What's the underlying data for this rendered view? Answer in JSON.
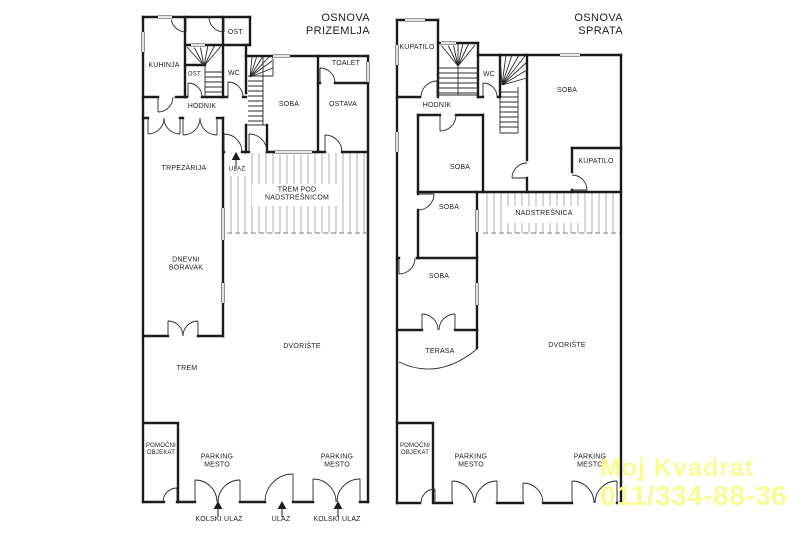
{
  "watermark": {
    "line1": "Moj Kvadrat",
    "line2": "011/334-88-36",
    "color": "#FAFA96"
  },
  "colors": {
    "walls": "#1b1b1b",
    "background": "#ffffff"
  },
  "plans": {
    "ground": {
      "title": "OSNOVA\nPRIZEMLJA",
      "labels": {
        "ost_top": "OST.",
        "kuhinja": "KUHINJA",
        "ost_small": "OST.",
        "wc": "WC",
        "hodnik": "HODNIK",
        "soba": "SOBA",
        "toalet": "TOALET",
        "ostava": "OSTAVA",
        "trpezarija": "TRPEZARIJA",
        "ulaz": "ULAZ",
        "trem_pod": "TREM POD\nNADSTREŠNICOM",
        "dnevni": "DNEVNI\nBORAVAK",
        "trem": "TREM",
        "dvoriste": "DVORIŠTE",
        "pomocni": "POMOĆNI\nOBJEKAT",
        "parking1": "PARKING\nMESTO",
        "parking2": "PARKING\nMESTO",
        "kolski1": "KOLSKI ULAZ",
        "ulaz_gate": "ULAZ",
        "kolski2": "KOLSKI ULAZ"
      }
    },
    "upper": {
      "title": "OSNOVA\nSPRATA",
      "labels": {
        "kupatilo1": "KUPATILO",
        "hodnik": "HODNIK",
        "wc": "WC",
        "soba_big": "SOBA",
        "kupatilo2": "KUPATILO",
        "soba1": "SOBA",
        "soba2": "SOBA",
        "nadstresnica": "NADSTREŠNICA",
        "soba3": "SOBA",
        "terasa": "TERASA",
        "dvoriste": "DVORIŠTE",
        "pomocni": "POMOĆNI\nOBJEKAT",
        "parking1": "PARKING\nMESTO",
        "parking2": "PARKING\nMESTO"
      }
    }
  }
}
